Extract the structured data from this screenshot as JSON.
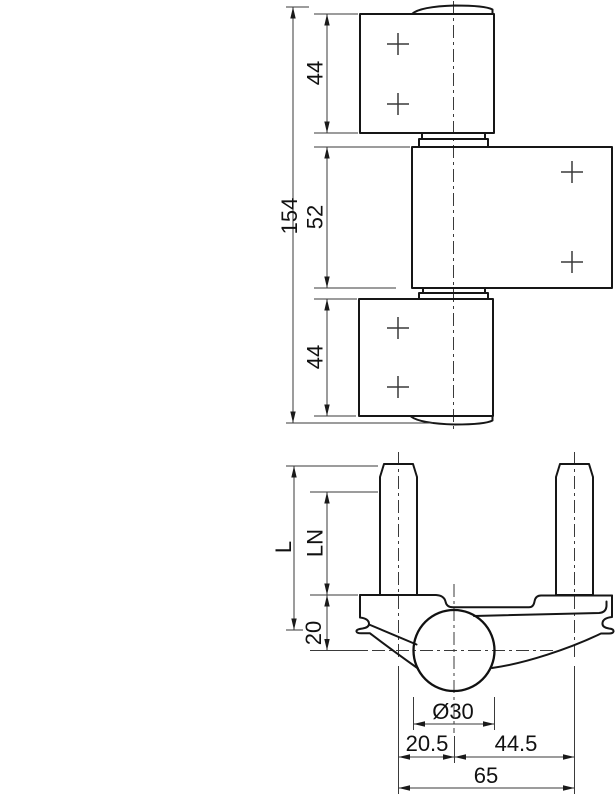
{
  "figure": {
    "description": "Technical drawing of a 3-part door hinge: front elevation (top) and frame-part cross section with fixing studs (bottom)",
    "colors": {
      "line": "#161616",
      "thin_line": "#3a3a3a",
      "text": "#111111",
      "background": "#ffffff"
    }
  },
  "front_view": {
    "dims": {
      "total_height": "154",
      "top_leaf": "44",
      "middle_leaf": "52",
      "bottom_leaf": "44"
    }
  },
  "section_view": {
    "dims": {
      "stud_length": "L",
      "thread_length": "LN",
      "top_to_axis": "20",
      "knuckle_diameter": "Ø30",
      "axis_to_left_stud": "20.5",
      "axis_to_right_stud": "44.5",
      "stud_spacing": "65"
    }
  }
}
